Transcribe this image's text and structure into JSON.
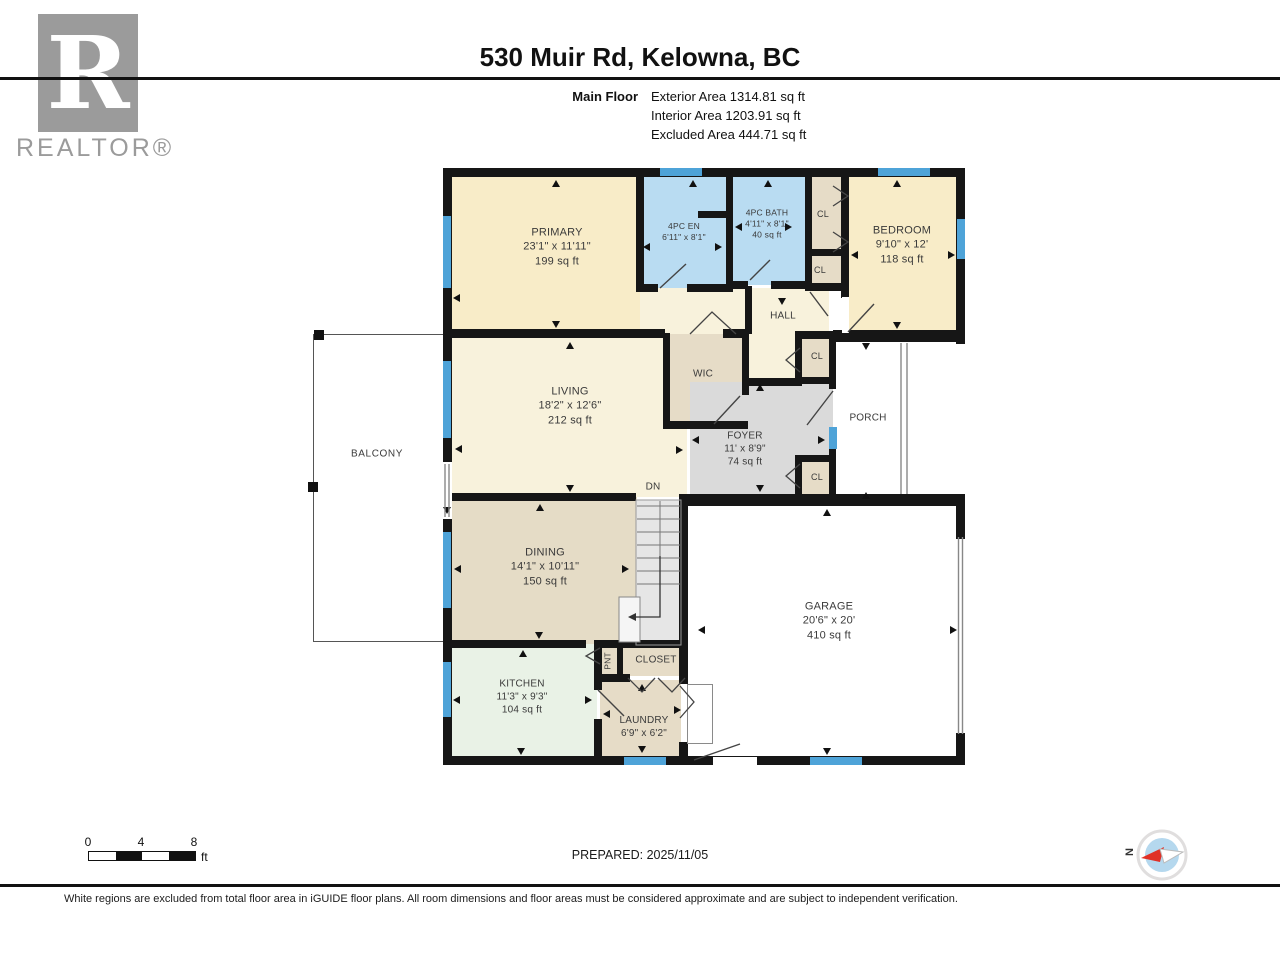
{
  "header": {
    "title": "530 Muir Rd, Kelowna, BC",
    "floor_label": "Main Floor",
    "stats": [
      "Exterior Area 1314.81 sq ft",
      "Interior Area 1203.91 sq ft",
      "Excluded Area 444.71 sq ft"
    ],
    "logo_letter": "R",
    "logo_text": "REALTOR®"
  },
  "rooms": {
    "primary": {
      "name": "PRIMARY",
      "dims": "23'1\" x 11'11\"",
      "area": "199 sq ft"
    },
    "ensuite": {
      "name": "4PC EN",
      "dims": "6'11\" x 8'1\""
    },
    "bath": {
      "name": "4PC BATH",
      "dims": "4'11\" x 8'1\"",
      "area": "40 sq ft"
    },
    "bedroom": {
      "name": "BEDROOM",
      "dims": "9'10\" x 12'",
      "area": "118 sq ft"
    },
    "hall": {
      "name": "HALL"
    },
    "wic": {
      "name": "WIC"
    },
    "living": {
      "name": "LIVING",
      "dims": "18'2\" x 12'6\"",
      "area": "212 sq ft"
    },
    "foyer": {
      "name": "FOYER",
      "dims": "11' x 8'9\"",
      "area": "74 sq ft"
    },
    "porch": {
      "name": "PORCH"
    },
    "dining": {
      "name": "DINING",
      "dims": "14'1\" x 10'11\"",
      "area": "150 sq ft"
    },
    "kitchen": {
      "name": "KITCHEN",
      "dims": "11'3\" x 9'3\"",
      "area": "104 sq ft"
    },
    "laundry": {
      "name": "LAUNDRY",
      "dims": "6'9\" x 6'2\""
    },
    "closet": {
      "name": "CLOSET"
    },
    "pantry": {
      "name": "PNT"
    },
    "garage": {
      "name": "GARAGE",
      "dims": "20'6\" x 20'",
      "area": "410 sq ft"
    },
    "balcony": {
      "name": "BALCONY"
    },
    "cl": {
      "name": "CL"
    },
    "stairs": {
      "name": "DN"
    }
  },
  "scalebar": {
    "labels": [
      "0",
      "4",
      "8"
    ],
    "unit": "ft"
  },
  "prepared": "PREPARED: 2025/11/05",
  "compass": {
    "north": "N"
  },
  "footer": "White regions are excluded from total floor area in iGUIDE floor plans. All room dimensions and floor areas must be considered approximate and are subject to independent verification.",
  "colors": {
    "wall": "#161616",
    "window": "#4ea3d8",
    "cream": "#f8ecc8",
    "cream_light": "#f8f2dc",
    "blue_room": "#b9dcf2",
    "tan": "#e6dcc7",
    "mint": "#e9f2e6",
    "foyer_gray": "#dadada",
    "compass_red": "#e03127"
  }
}
